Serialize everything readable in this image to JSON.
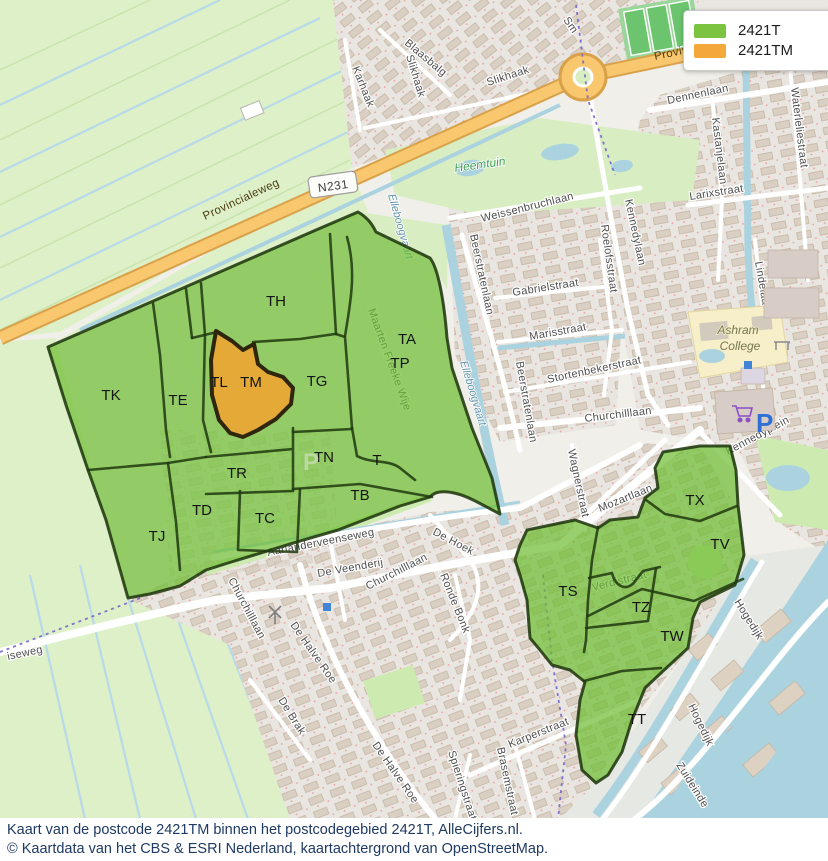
{
  "legend": {
    "items": [
      {
        "label": "2421T",
        "color": "#7cc342"
      },
      {
        "label": "2421TM",
        "color": "#f5a83a"
      }
    ]
  },
  "caption": {
    "line1": "Kaart van de postcode 2421TM binnen het postcodegebied 2421T, AlleCijfers.nl.",
    "line2": "© Kaartdata van het CBS & ESRI Nederland, kaartachtergrond van OpenStreetMap."
  },
  "map": {
    "road_badge": "N231",
    "region_labels": [
      "TH",
      "TA",
      "TP",
      "TK",
      "TE",
      "TL",
      "TM",
      "TG",
      "TN",
      "T",
      "TR",
      "TB",
      "TD",
      "TC",
      "TJ",
      "TS",
      "TZ",
      "TX",
      "TV",
      "TW",
      "TT"
    ],
    "streets": [
      "Blaasbalg",
      "Karhaak",
      "Slikhaak",
      "Slikhaak",
      "Sm",
      "Provincialeweg",
      "Provincialeweg",
      "Dennenlaan",
      "Weissenbruchlaan",
      "Beerstratenlaan",
      "Beerstratenlaan",
      "Gabrielstraat",
      "Roelofsstraat",
      "Kennedylaan",
      "Marisstraat",
      "Stortenbekerstraat",
      "Churchilllaan",
      "Larixstraat",
      "Kastanjelaan",
      "Waterleliestraat",
      "Lindelaan",
      "Maarten Freeke Wije",
      "Kennedyplein",
      "Aarlanderveenseweg",
      "De Veenderij",
      "Churchilllaan",
      "Churchilllaan",
      "De Hoek",
      "Ronde Bonk",
      "De Halve Roe",
      "De Halve Roe",
      "De Brak",
      "Karperstraat",
      "Brasemstraat",
      "Spieringstraat",
      "Mozartlaan",
      "Wagnerstraat",
      "Verdistraat",
      "Hogedijk",
      "Hogedijk",
      "Zuideinde",
      "iseweg"
    ],
    "water_labels": [
      "Elleboogvaart",
      "Elleboogvaart"
    ],
    "place_labels": {
      "heemtuin": "Heemtuin",
      "ashram_line1": "Ashram",
      "ashram_line2": "College"
    },
    "icons": {
      "parking": "P",
      "parking_small": "P"
    },
    "colors": {
      "postcode_region": "#7cc342",
      "highlight_region": "#f0a432",
      "region_border": "#20380f",
      "road_primary": "#f8c76e",
      "water": "#aad3df",
      "farmland": "#def0c8",
      "residential": "#e9e6e1",
      "building": "#d9cfc3"
    }
  }
}
